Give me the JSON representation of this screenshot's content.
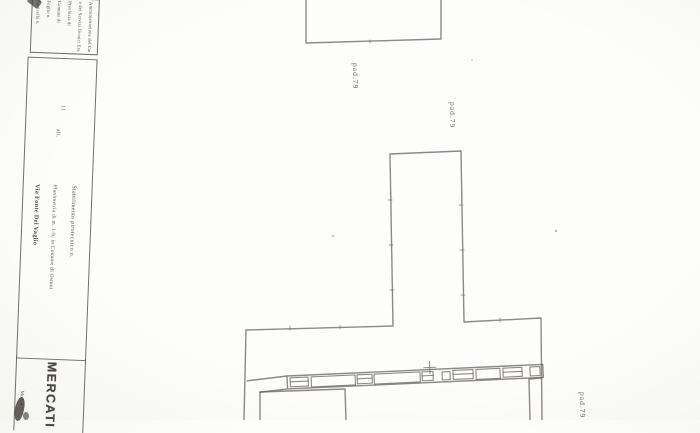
{
  "colors": {
    "ink": "#6e685f",
    "paper": "#fdfdfb",
    "stamp": "#4a453e"
  },
  "title_block": {
    "header_lines": [
      "Amministrazione del Catasto",
      "e dei Servizi Tecnici Erariali",
      "Provincia di",
      "Comune di",
      "Foglio n.",
      "Particella n."
    ],
    "altitude_value": "11",
    "altitude_label": "alt.",
    "description_lines": [
      "Stabilimento pirotecnico n.",
      "Planimetria di m. 1-b; in Comune di Ostuni",
      "Via Fonte Del Vaglio"
    ],
    "stamp_text": "MERCATI",
    "edge_text": "Mod. 4"
  },
  "plan": {
    "labels": [
      {
        "text": "pad.79"
      },
      {
        "text": "pad.79"
      },
      {
        "text": "pad.79"
      }
    ]
  }
}
